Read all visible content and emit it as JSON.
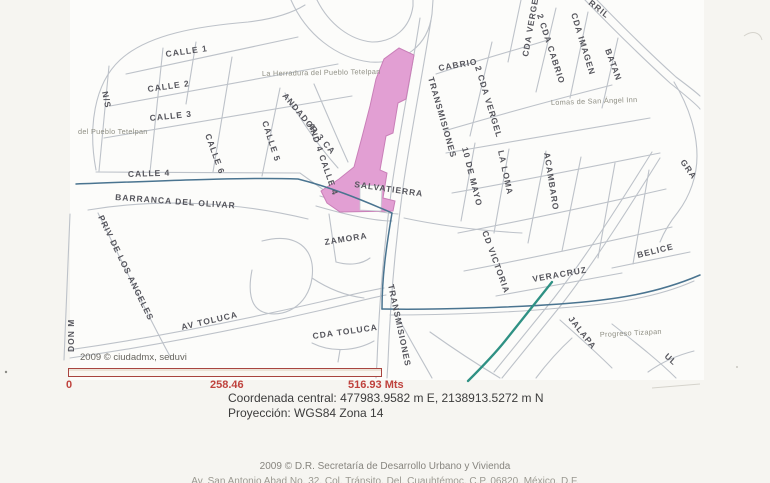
{
  "map": {
    "area_labels": {
      "herradura": "La Herradura del Pueblo Tetelpan",
      "pueblo": "del Pueblo Tetelpan",
      "lomas": "Lomas de San Ángel Inn",
      "progreso": "Progreso Tizapan"
    },
    "streets": {
      "calle1": "CALLE 1",
      "calle2": "CALLE 2",
      "calle3": "CALLE 3",
      "calle4": "CALLE 4",
      "calle5": "CALLE 5",
      "calle6": "CALLE 6",
      "ns": "N/S",
      "andador3": "ANDADOR 3 CA",
      "and4": "AND 4 CALLE 4",
      "barranca": "BARRANCA DEL OLIVAR",
      "priv": "PRIV DE LOS ANGELES",
      "donm": "DON M",
      "avtoluca": "AV TOLUCA",
      "cdatoluca": "CDA TOLUCA",
      "zamora": "ZAMORA",
      "salvatierra": "SALVATIERRA",
      "transmisiones_n": "TRANSMISIONES",
      "transmisiones_s": "TRANSMISIONES",
      "cabrio": "CABRIO",
      "cdavergel": "CDA VERGEL",
      "vergel2": "2 CDA VERGEL",
      "cabrio2": "2 CDA CABRIO",
      "imagen": "CDA IMAGEN",
      "batan": "BATAN",
      "rril": "RRIL",
      "mayo": "10 DE MAYO",
      "laloma": "LA LOMA",
      "acambaro": "ACAMBARO",
      "victoria": "CD VICTORIA",
      "veracruz": "VERACRUZ",
      "belice": "BELICE",
      "jalapa": "JALAPA",
      "gra": "GRA",
      "ul": "UL"
    },
    "credit": "2009 © ciudadmx, seduvi"
  },
  "scalebar": {
    "t0": "0",
    "t1": "258.46",
    "t2": "516.93 Mts"
  },
  "info": {
    "coordinates": "Coordenada central: 477983.9582 m E, 2138913.5272 m N",
    "projection": "Proyección: WGS84 Zona 14"
  },
  "footer": {
    "credit": "2009 © D.R. Secretaría de Desarrollo Urbano y Vivienda",
    "clipped": "Av. San Antonio Abad No. 32, Col. Tránsito, Del. Cuauhtémoc, C.P. 06820, México, D.F."
  },
  "colors": {
    "parcel": "#e29fd3",
    "stream": "#4a7490",
    "stream_green": "#2f9184",
    "scalebar_red": "#bf423d",
    "road_gray": "#bdc2c9"
  }
}
